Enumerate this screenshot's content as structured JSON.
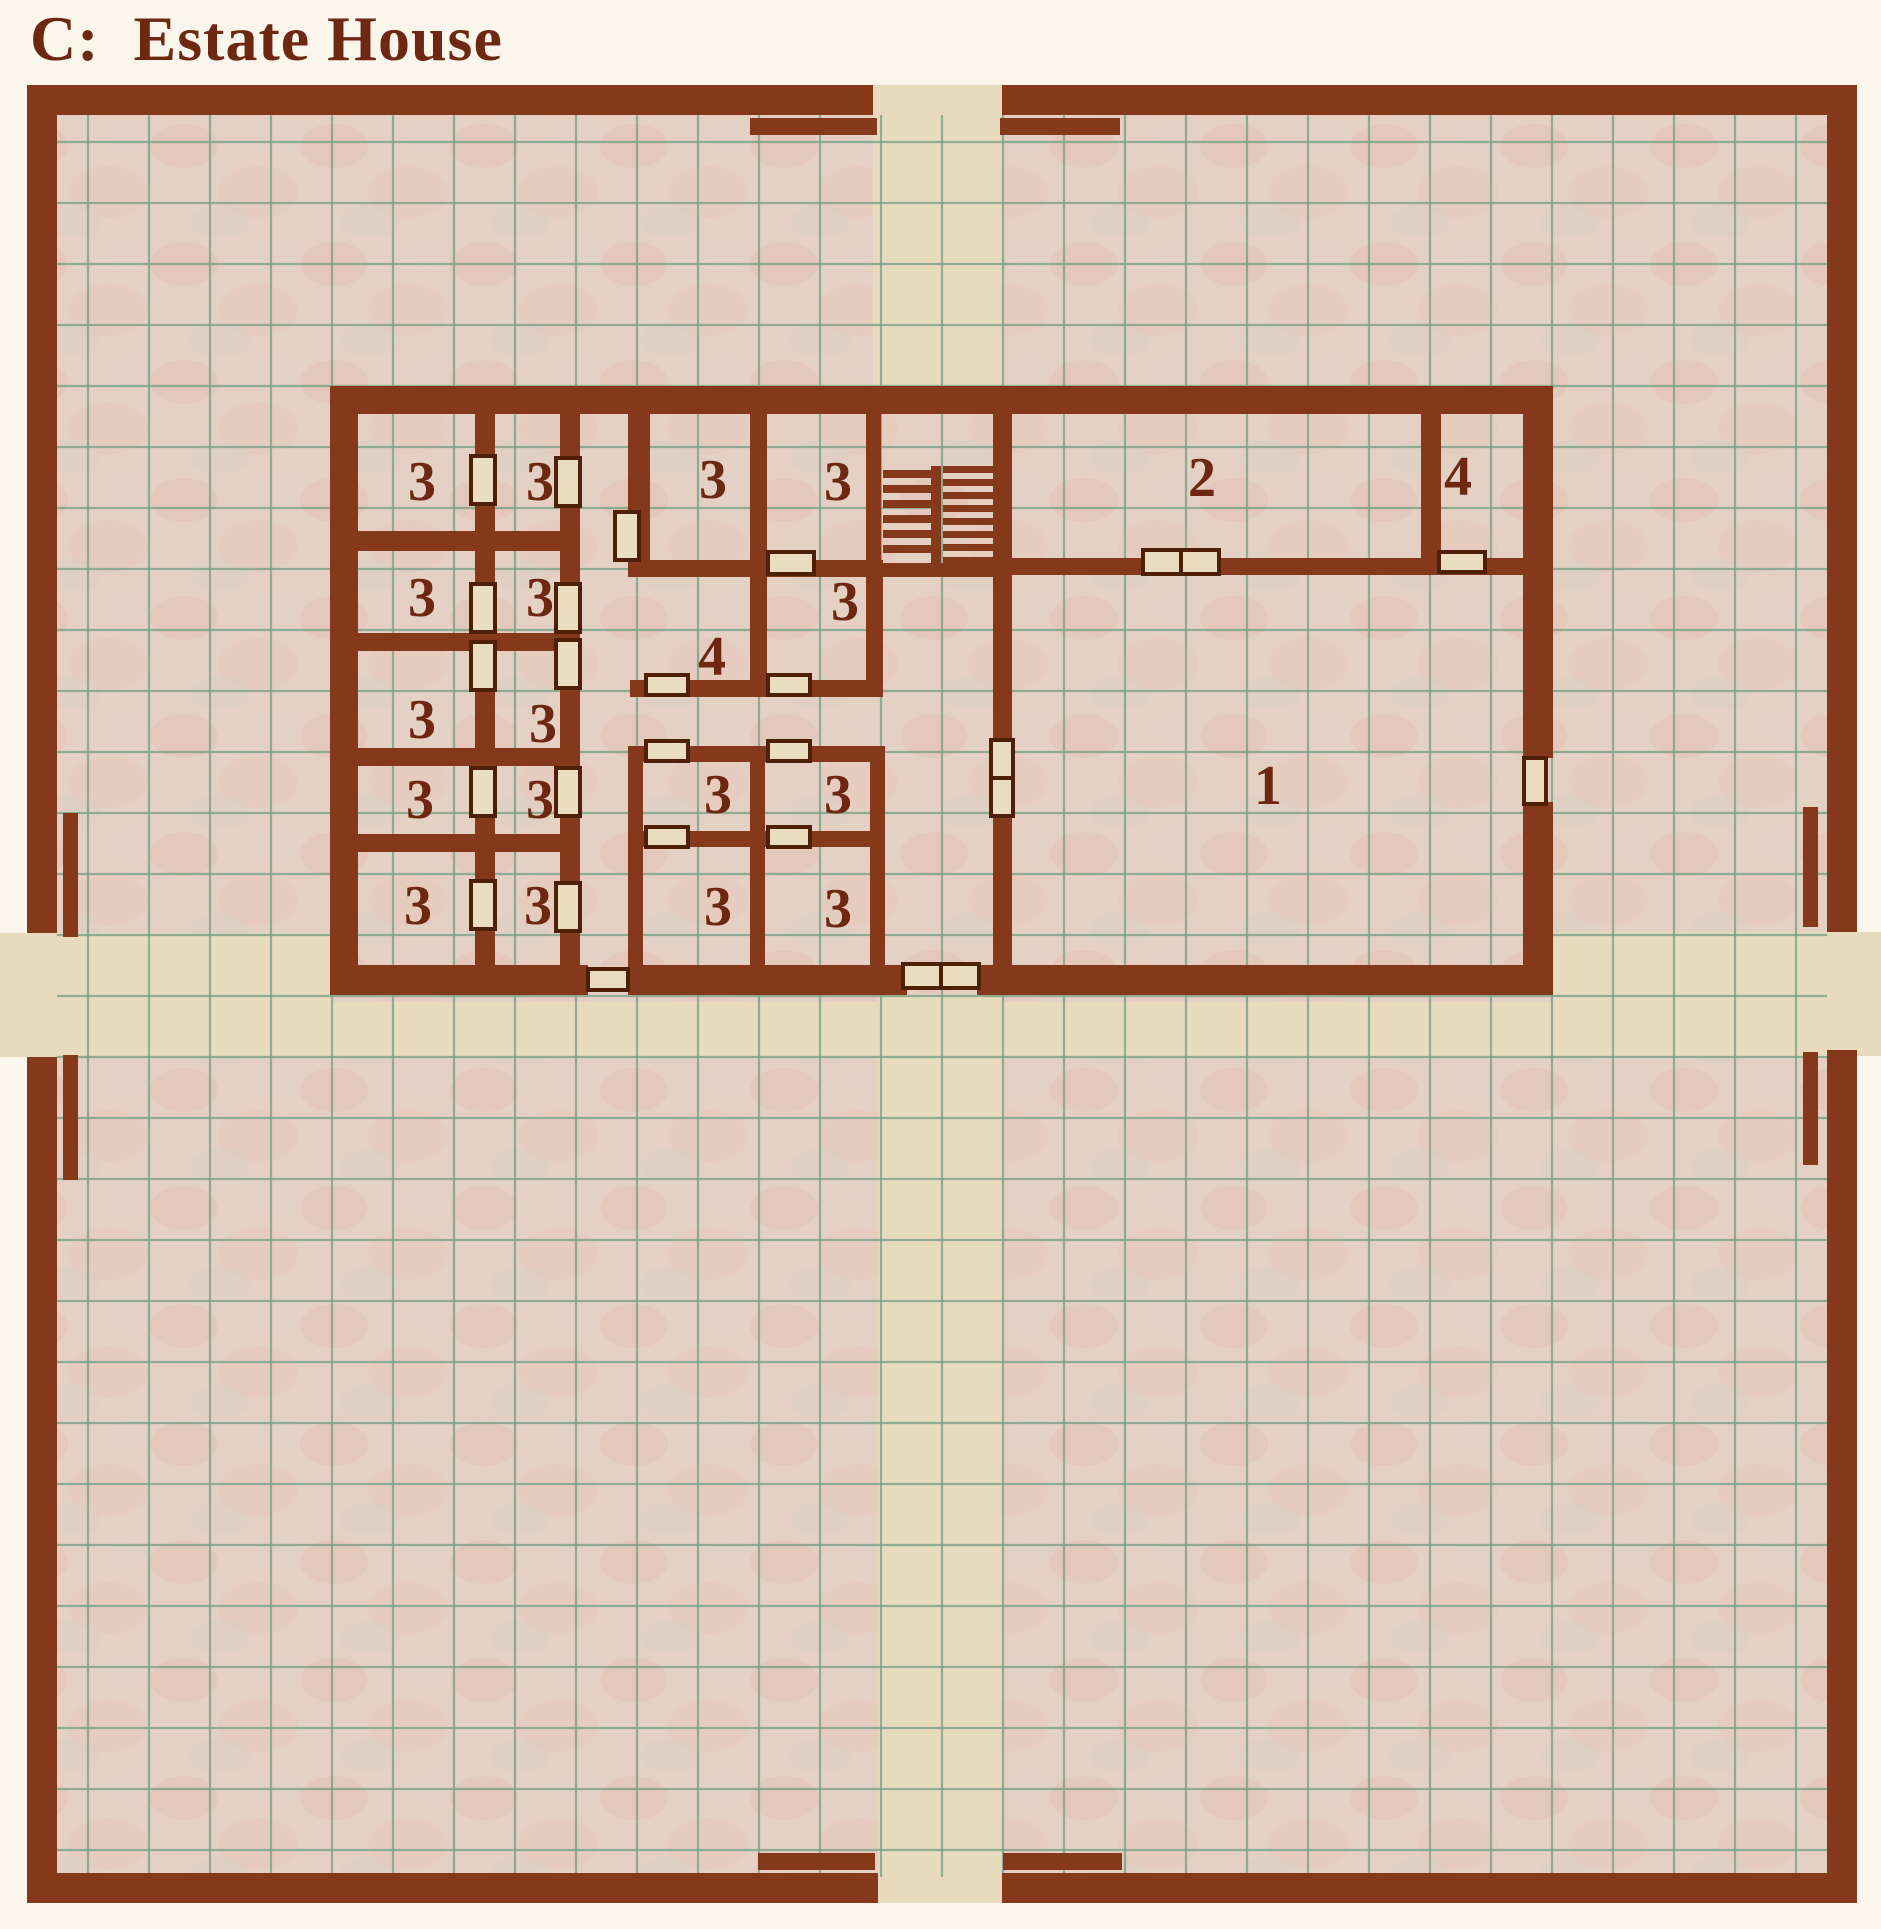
{
  "page": {
    "title": "C:  Estate House"
  },
  "palette": {
    "page_bg": "#faf6ec",
    "map_bg": "#e5d0c4",
    "road": "#e8dabd",
    "grid": "#7aa287",
    "wall": "#86381a",
    "door_fill": "#eadcbe",
    "door_edge": "#4f2008",
    "label": "#6e2812",
    "title": "#6e2812"
  },
  "map": {
    "width": 1881,
    "height": 1929,
    "bounds": {
      "x": 27,
      "y": 85,
      "w": 1830,
      "h": 1818
    },
    "grid": {
      "x0": 88,
      "y0": 142,
      "pitch": 61,
      "nx": 29,
      "ny": 29,
      "clip": {
        "x": 57,
        "y": 115,
        "x2": 1827,
        "y2": 1877
      }
    },
    "roads": [
      {
        "x": 873,
        "y": 85,
        "w": 129,
        "h": 307
      },
      {
        "x": 878,
        "y": 997,
        "w": 124,
        "h": 906
      },
      {
        "x": 0,
        "y": 933,
        "w": 332,
        "h": 124
      },
      {
        "x": 1553,
        "y": 932,
        "w": 328,
        "h": 124
      },
      {
        "x": 332,
        "y": 1002,
        "w": 1221,
        "h": 55
      }
    ],
    "outer_wall": [
      {
        "x": 27,
        "y": 85,
        "w": 846,
        "h": 30
      },
      {
        "x": 1002,
        "y": 85,
        "w": 855,
        "h": 30
      },
      {
        "x": 27,
        "y": 1873,
        "w": 851,
        "h": 30
      },
      {
        "x": 1002,
        "y": 1873,
        "w": 855,
        "h": 30
      },
      {
        "x": 27,
        "y": 85,
        "w": 30,
        "h": 848
      },
      {
        "x": 27,
        "y": 1057,
        "w": 30,
        "h": 846
      },
      {
        "x": 1827,
        "y": 85,
        "w": 30,
        "h": 847
      },
      {
        "x": 1827,
        "y": 1050,
        "w": 30,
        "h": 853
      }
    ],
    "gate_baffles": [
      {
        "x": 750,
        "y": 118,
        "w": 127,
        "h": 17
      },
      {
        "x": 1000,
        "y": 118,
        "w": 120,
        "h": 17
      },
      {
        "x": 758,
        "y": 1853,
        "w": 117,
        "h": 17
      },
      {
        "x": 1003,
        "y": 1853,
        "w": 119,
        "h": 17
      },
      {
        "x": 63,
        "y": 813,
        "w": 15,
        "h": 124
      },
      {
        "x": 63,
        "y": 1055,
        "w": 15,
        "h": 125
      },
      {
        "x": 1803,
        "y": 807,
        "w": 15,
        "h": 120
      },
      {
        "x": 1803,
        "y": 1052,
        "w": 15,
        "h": 113
      }
    ]
  },
  "building": {
    "walls": [
      {
        "x": 330,
        "y": 386,
        "w": 1223,
        "h": 28
      },
      {
        "x": 330,
        "y": 386,
        "w": 28,
        "h": 609
      },
      {
        "x": 330,
        "y": 965,
        "w": 258,
        "h": 30
      },
      {
        "x": 628,
        "y": 965,
        "w": 279,
        "h": 30
      },
      {
        "x": 977,
        "y": 965,
        "w": 576,
        "h": 30
      },
      {
        "x": 1523,
        "y": 386,
        "w": 30,
        "h": 372
      },
      {
        "x": 1523,
        "y": 802,
        "w": 30,
        "h": 193
      },
      {
        "x": 475,
        "y": 414,
        "w": 20,
        "h": 551
      },
      {
        "x": 560,
        "y": 414,
        "w": 20,
        "h": 551
      },
      {
        "x": 330,
        "y": 531,
        "w": 250,
        "h": 20
      },
      {
        "x": 330,
        "y": 633,
        "w": 250,
        "h": 18
      },
      {
        "x": 330,
        "y": 748,
        "w": 250,
        "h": 18
      },
      {
        "x": 330,
        "y": 834,
        "w": 250,
        "h": 18
      },
      {
        "x": 628,
        "y": 414,
        "w": 22,
        "h": 163
      },
      {
        "x": 750,
        "y": 414,
        "w": 17,
        "h": 163
      },
      {
        "x": 866,
        "y": 414,
        "w": 15,
        "h": 166
      },
      {
        "x": 628,
        "y": 560,
        "w": 255,
        "h": 17
      },
      {
        "x": 750,
        "y": 577,
        "w": 17,
        "h": 120
      },
      {
        "x": 866,
        "y": 577,
        "w": 17,
        "h": 120
      },
      {
        "x": 630,
        "y": 680,
        "w": 253,
        "h": 17
      },
      {
        "x": 628,
        "y": 746,
        "w": 257,
        "h": 16
      },
      {
        "x": 628,
        "y": 746,
        "w": 15,
        "h": 219
      },
      {
        "x": 750,
        "y": 746,
        "w": 15,
        "h": 219
      },
      {
        "x": 870,
        "y": 746,
        "w": 15,
        "h": 219
      },
      {
        "x": 628,
        "y": 831,
        "w": 257,
        "h": 16
      },
      {
        "x": 993,
        "y": 386,
        "w": 19,
        "h": 579
      },
      {
        "x": 866,
        "y": 563,
        "w": 146,
        "h": 14
      },
      {
        "x": 1012,
        "y": 558,
        "w": 511,
        "h": 17
      },
      {
        "x": 1421,
        "y": 386,
        "w": 20,
        "h": 172
      }
    ],
    "stairs": {
      "flights": [
        {
          "x": 883,
          "w": 48,
          "h": 8,
          "ys": [
            470,
            485,
            500,
            515,
            530,
            545
          ]
        },
        {
          "x": 943,
          "w": 50,
          "h": 7,
          "ys": [
            466,
            479,
            492,
            505,
            518,
            531,
            544,
            557
          ]
        }
      ],
      "divider": {
        "x": 931,
        "y": 466,
        "w": 10,
        "h": 97
      }
    },
    "doors": [
      {
        "x": 471,
        "y": 456,
        "w": 24,
        "h": 48
      },
      {
        "x": 471,
        "y": 584,
        "w": 24,
        "h": 48
      },
      {
        "x": 471,
        "y": 642,
        "w": 24,
        "h": 48
      },
      {
        "x": 471,
        "y": 768,
        "w": 24,
        "h": 48
      },
      {
        "x": 471,
        "y": 881,
        "w": 24,
        "h": 48
      },
      {
        "x": 556,
        "y": 458,
        "w": 24,
        "h": 48
      },
      {
        "x": 556,
        "y": 584,
        "w": 24,
        "h": 48
      },
      {
        "x": 556,
        "y": 640,
        "w": 24,
        "h": 48
      },
      {
        "x": 556,
        "y": 768,
        "w": 24,
        "h": 48
      },
      {
        "x": 556,
        "y": 883,
        "w": 24,
        "h": 48
      },
      {
        "x": 615,
        "y": 512,
        "w": 24,
        "h": 48
      },
      {
        "x": 768,
        "y": 552,
        "w": 46,
        "h": 22
      },
      {
        "x": 646,
        "y": 675,
        "w": 42,
        "h": 20
      },
      {
        "x": 768,
        "y": 675,
        "w": 42,
        "h": 20
      },
      {
        "x": 646,
        "y": 741,
        "w": 42,
        "h": 20
      },
      {
        "x": 768,
        "y": 741,
        "w": 42,
        "h": 20
      },
      {
        "x": 646,
        "y": 827,
        "w": 42,
        "h": 20
      },
      {
        "x": 768,
        "y": 827,
        "w": 42,
        "h": 20
      },
      {
        "x": 588,
        "y": 969,
        "w": 40,
        "h": 21
      },
      {
        "x": 903,
        "y": 964,
        "w": 38,
        "h": 24
      },
      {
        "x": 941,
        "y": 964,
        "w": 38,
        "h": 24
      },
      {
        "x": 991,
        "y": 740,
        "w": 22,
        "h": 38
      },
      {
        "x": 991,
        "y": 778,
        "w": 22,
        "h": 38
      },
      {
        "x": 1143,
        "y": 550,
        "w": 38,
        "h": 24
      },
      {
        "x": 1181,
        "y": 550,
        "w": 38,
        "h": 24
      },
      {
        "x": 1439,
        "y": 552,
        "w": 46,
        "h": 20
      },
      {
        "x": 1524,
        "y": 758,
        "w": 22,
        "h": 46
      }
    ],
    "labels": [
      {
        "x": 422,
        "y": 482,
        "t": "3"
      },
      {
        "x": 540,
        "y": 482,
        "t": "3"
      },
      {
        "x": 422,
        "y": 598,
        "t": "3"
      },
      {
        "x": 540,
        "y": 598,
        "t": "3"
      },
      {
        "x": 422,
        "y": 720,
        "t": "3"
      },
      {
        "x": 543,
        "y": 724,
        "t": "3"
      },
      {
        "x": 420,
        "y": 800,
        "t": "3"
      },
      {
        "x": 540,
        "y": 800,
        "t": "3"
      },
      {
        "x": 418,
        "y": 906,
        "t": "3"
      },
      {
        "x": 538,
        "y": 906,
        "t": "3"
      },
      {
        "x": 713,
        "y": 480,
        "t": "3"
      },
      {
        "x": 838,
        "y": 482,
        "t": "3"
      },
      {
        "x": 845,
        "y": 602,
        "t": "3"
      },
      {
        "x": 712,
        "y": 657,
        "t": "4"
      },
      {
        "x": 718,
        "y": 795,
        "t": "3"
      },
      {
        "x": 838,
        "y": 795,
        "t": "3"
      },
      {
        "x": 718,
        "y": 907,
        "t": "3"
      },
      {
        "x": 838,
        "y": 909,
        "t": "3"
      },
      {
        "x": 1202,
        "y": 478,
        "t": "2"
      },
      {
        "x": 1458,
        "y": 477,
        "t": "4"
      },
      {
        "x": 1268,
        "y": 786,
        "t": "1"
      }
    ]
  }
}
